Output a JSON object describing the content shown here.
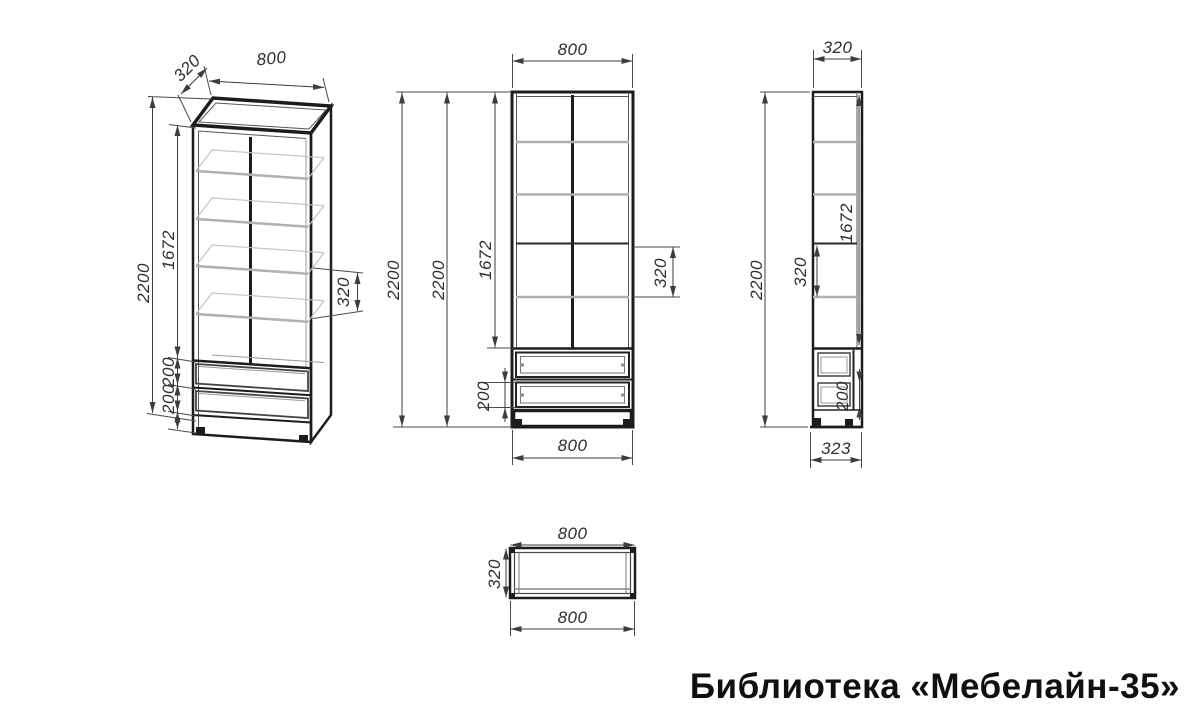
{
  "title": "Библиотека «Мебелайн-35»",
  "views": {
    "isometric": {
      "dims": {
        "depth": "320",
        "width": "800",
        "height": "2200",
        "shelf_section": "1672",
        "drawer_top": "200",
        "drawer_bottom": "200",
        "shelf_gap": "320"
      }
    },
    "front": {
      "dims": {
        "width": "800",
        "height_outer": "2200",
        "height_inner": "2200",
        "shelf_section": "1672",
        "shelf_gap": "320",
        "drawer": "200",
        "width_bottom": "800"
      }
    },
    "side": {
      "dims": {
        "depth": "320",
        "height": "2200",
        "shelf_gap": "320",
        "shelf_section": "1672",
        "drawer": "200",
        "depth_bottom": "323"
      }
    },
    "top": {
      "dims": {
        "width": "800",
        "depth": "320",
        "width_bottom": "800"
      }
    }
  }
}
